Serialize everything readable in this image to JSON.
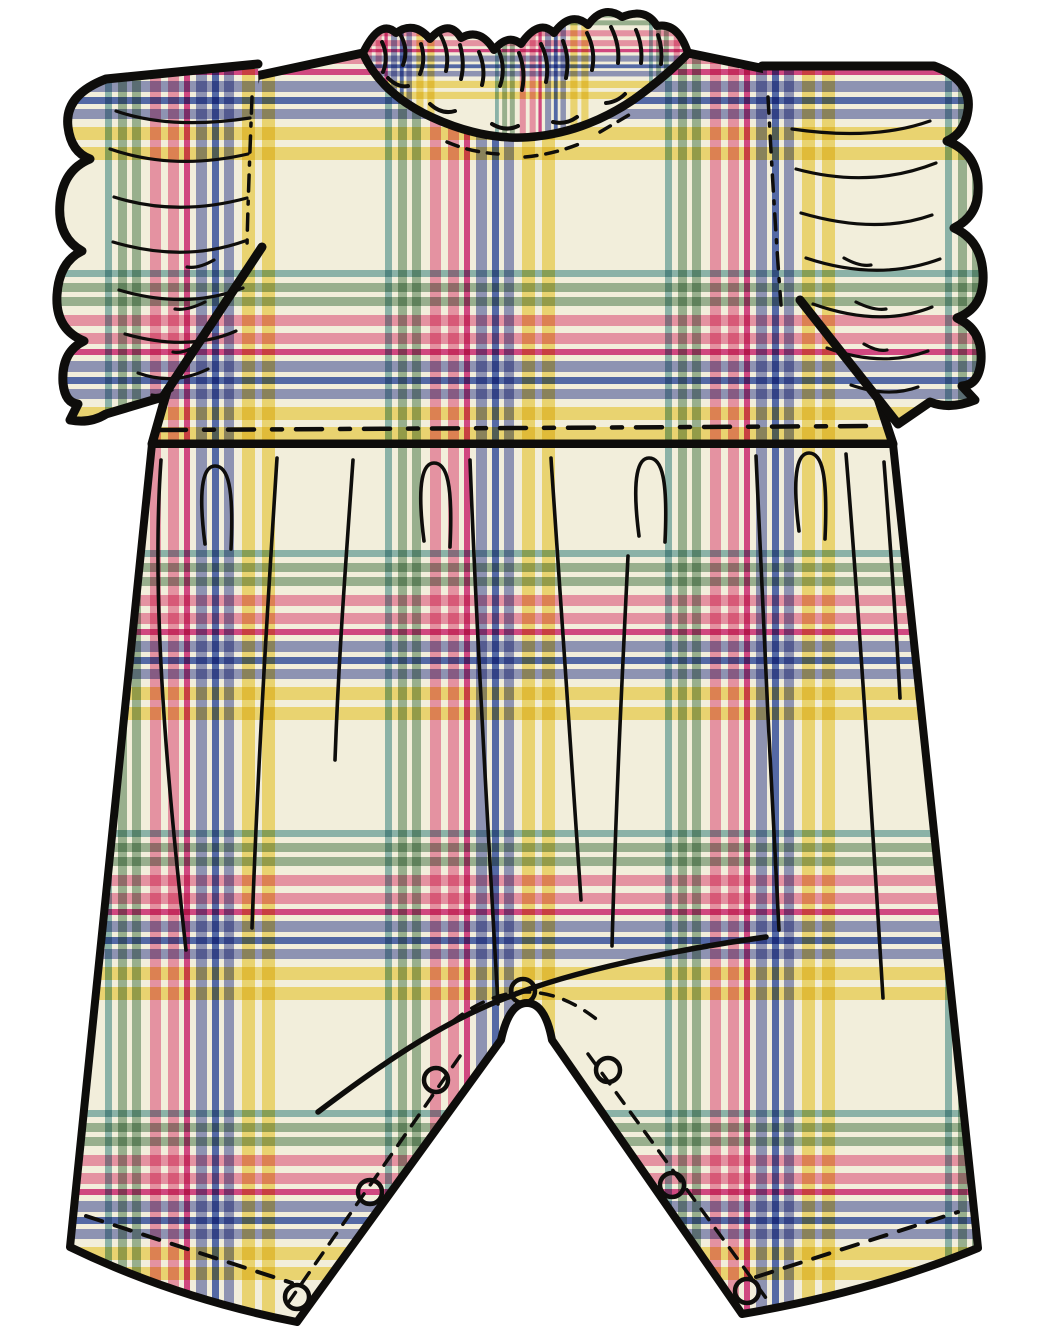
{
  "meta": {
    "description": "Technical flat sketch of a baby flutter-sleeve romper (back view) in a pastel madras plaid, with ruffled neckline, ruffled cap sleeves, gathered waist seam and inner-leg snap placket",
    "view": "back"
  },
  "canvas": {
    "width": 1048,
    "height": 1342,
    "background": "#ffffff"
  },
  "line": {
    "color": "#0e0d0b"
  },
  "fabric": {
    "base": "#f2eedb",
    "tile": 280,
    "offset_x": 105,
    "offset_y": -10,
    "collar_scale": 0.55,
    "stripes": [
      {
        "pos": 0,
        "width": 7,
        "color": "#4a949b",
        "opacity": 0.6
      },
      {
        "pos": 13,
        "width": 9,
        "color": "#88ab8d",
        "opacity": 0.8
      },
      {
        "pos": 27,
        "width": 9,
        "color": "#88ab8d",
        "opacity": 0.8
      },
      {
        "pos": 45,
        "width": 11,
        "color": "#ef8bb0",
        "opacity": 0.85
      },
      {
        "pos": 63,
        "width": 11,
        "color": "#ef8bb0",
        "opacity": 0.85
      },
      {
        "pos": 79,
        "width": 6,
        "color": "#d62e83",
        "opacity": 0.85
      },
      {
        "pos": 91,
        "width": 11,
        "color": "#8b94ca",
        "opacity": 0.9
      },
      {
        "pos": 107,
        "width": 7,
        "color": "#3b57b5",
        "opacity": 0.85
      },
      {
        "pos": 119,
        "width": 10,
        "color": "#8b94ca",
        "opacity": 0.9
      },
      {
        "pos": 137,
        "width": 13,
        "color": "#f6df75",
        "opacity": 0.9
      },
      {
        "pos": 157,
        "width": 13,
        "color": "#f6df75",
        "opacity": 0.9
      }
    ]
  },
  "snaps": {
    "radius": 12,
    "stroke_width": 4.5,
    "positions": [
      {
        "x": 523,
        "y": 991
      },
      {
        "x": 436,
        "y": 1080
      },
      {
        "x": 370,
        "y": 1192
      },
      {
        "x": 297,
        "y": 1297
      },
      {
        "x": 608,
        "y": 1070
      },
      {
        "x": 672,
        "y": 1185
      },
      {
        "x": 747,
        "y": 1291
      }
    ]
  },
  "details": {
    "snap_count": 7,
    "collar_scallops": 6,
    "sleeve_ruffle_lobes": 4,
    "closure": "snap placket along inner legs"
  }
}
